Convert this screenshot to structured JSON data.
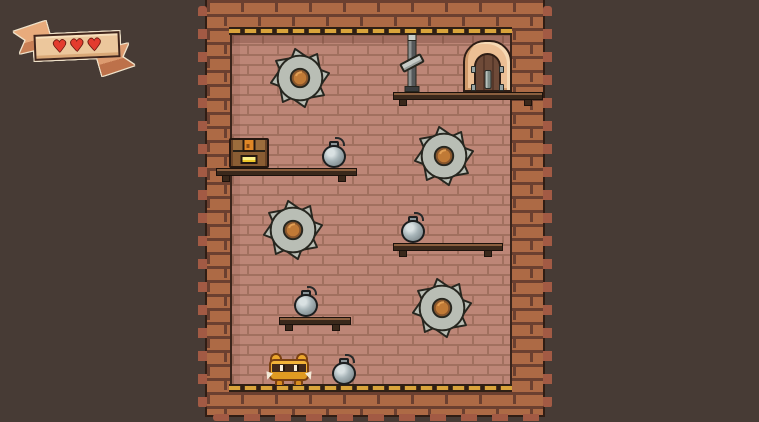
{
  "scene": {
    "background_color": "#473b35",
    "wall_brick_color": "#bd8677",
    "border_brick_color": "#ad6a45",
    "trim_gold_color": "#d9a43b",
    "platform_wood_color": "#3a281b"
  },
  "hud": {
    "health": {
      "hearts_current": 3,
      "hearts_max": 3,
      "hearts_display": "♥♥♥",
      "heart_color": "#e33b2e",
      "banner_color": "#ecc79c"
    }
  },
  "level": {
    "entities": [
      {
        "type": "platform",
        "name": "platform",
        "interactable": false,
        "x": 393,
        "y": 92,
        "w": 150,
        "h": 8
      },
      {
        "type": "platform",
        "name": "platform",
        "interactable": false,
        "x": 216,
        "y": 168,
        "w": 141,
        "h": 8
      },
      {
        "type": "platform",
        "name": "platform",
        "interactable": false,
        "x": 393,
        "y": 243,
        "w": 110,
        "h": 8
      },
      {
        "type": "platform",
        "name": "platform",
        "interactable": false,
        "x": 279,
        "y": 317,
        "w": 72,
        "h": 8
      },
      {
        "type": "saw-blade",
        "name": "saw-blade-hazard",
        "interactable": false,
        "x": 268,
        "y": 46,
        "w": 64,
        "h": 64
      },
      {
        "type": "saw-blade",
        "name": "saw-blade-hazard",
        "interactable": false,
        "x": 412,
        "y": 124,
        "w": 64,
        "h": 64
      },
      {
        "type": "saw-blade",
        "name": "saw-blade-hazard",
        "interactable": false,
        "x": 261,
        "y": 198,
        "w": 64,
        "h": 64
      },
      {
        "type": "saw-blade",
        "name": "saw-blade-hazard",
        "interactable": false,
        "x": 410,
        "y": 276,
        "w": 64,
        "h": 64
      },
      {
        "type": "chest",
        "name": "treasure-chest",
        "interactable": true,
        "x": 229,
        "y": 138,
        "w": 40,
        "h": 30
      },
      {
        "type": "bomb",
        "name": "bomb",
        "interactable": true,
        "x": 322,
        "y": 138,
        "w": 24,
        "h": 30
      },
      {
        "type": "bomb",
        "name": "bomb",
        "interactable": true,
        "x": 401,
        "y": 213,
        "w": 24,
        "h": 30
      },
      {
        "type": "bomb",
        "name": "bomb",
        "interactable": true,
        "x": 294,
        "y": 287,
        "w": 24,
        "h": 30
      },
      {
        "type": "bomb",
        "name": "bomb",
        "interactable": true,
        "x": 332,
        "y": 355,
        "w": 24,
        "h": 30
      },
      {
        "type": "door",
        "name": "exit-door",
        "interactable": true,
        "x": 463,
        "y": 40,
        "w": 49,
        "h": 52
      },
      {
        "type": "lever",
        "name": "lever-switch",
        "interactable": true,
        "x": 401,
        "y": 34,
        "w": 22,
        "h": 58
      },
      {
        "type": "player",
        "name": "player-character",
        "interactable": true,
        "x": 266,
        "y": 353,
        "w": 46,
        "h": 32
      }
    ]
  }
}
